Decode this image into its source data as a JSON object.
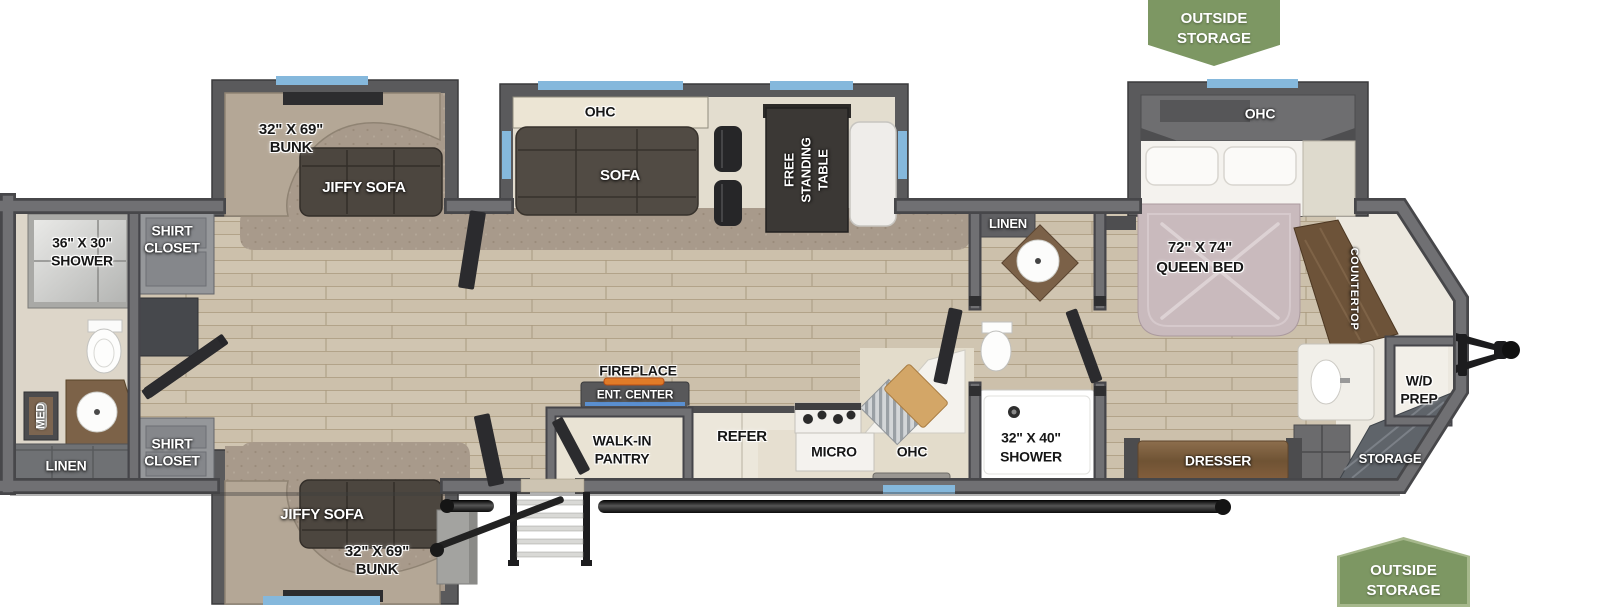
{
  "badges": {
    "outside_storage_top": {
      "line1": "OUTSIDE",
      "line2": "STORAGE"
    },
    "outside_storage_bottom": {
      "line1": "OUTSIDE",
      "line2": "STORAGE"
    }
  },
  "bunk_room_top": {
    "dim": "32\" X 69\"",
    "label": "BUNK",
    "sofa": "JIFFY SOFA"
  },
  "bunk_room_bottom": {
    "dim": "32\" X 69\"",
    "label": "BUNK",
    "sofa": "JIFFY SOFA"
  },
  "rear_bath": {
    "shower_dim": "36\" X 30\"",
    "shower": "SHOWER",
    "med": "MED",
    "linen": "LINEN"
  },
  "closets": {
    "shirt_top_line1": "SHIRT",
    "shirt_top_line2": "CLOSET",
    "shirt_bottom_line1": "SHIRT",
    "shirt_bottom_line2": "CLOSET"
  },
  "living": {
    "ohc": "OHC",
    "sofa": "SOFA",
    "table_line1": "FREE",
    "table_line2": "STANDING",
    "table_line3": "TABLE",
    "fireplace": "FIREPLACE",
    "ent_center": "ENT. CENTER"
  },
  "kitchen": {
    "pantry_line1": "WALK-IN",
    "pantry_line2": "PANTRY",
    "refer": "REFER",
    "micro": "MICRO",
    "ohc": "OHC"
  },
  "mid_bath": {
    "linen": "LINEN",
    "shower_dim": "32\" X 40\"",
    "shower": "SHOWER"
  },
  "bedroom": {
    "ohc": "OHC",
    "bed_dim": "72\" X 74\"",
    "bed_label": "QUEEN BED",
    "countertop": "COUNTERTOP",
    "wd_line1": "W/D",
    "wd_line2": "PREP",
    "dresser": "DRESSER",
    "storage": "STORAGE"
  },
  "colors": {
    "badge_green": "#7d9763",
    "window_blue": "#85b8dc",
    "wall_gray": "#707073",
    "floor_wood": "#d0c5b1",
    "carpet": "#a89a8b"
  }
}
